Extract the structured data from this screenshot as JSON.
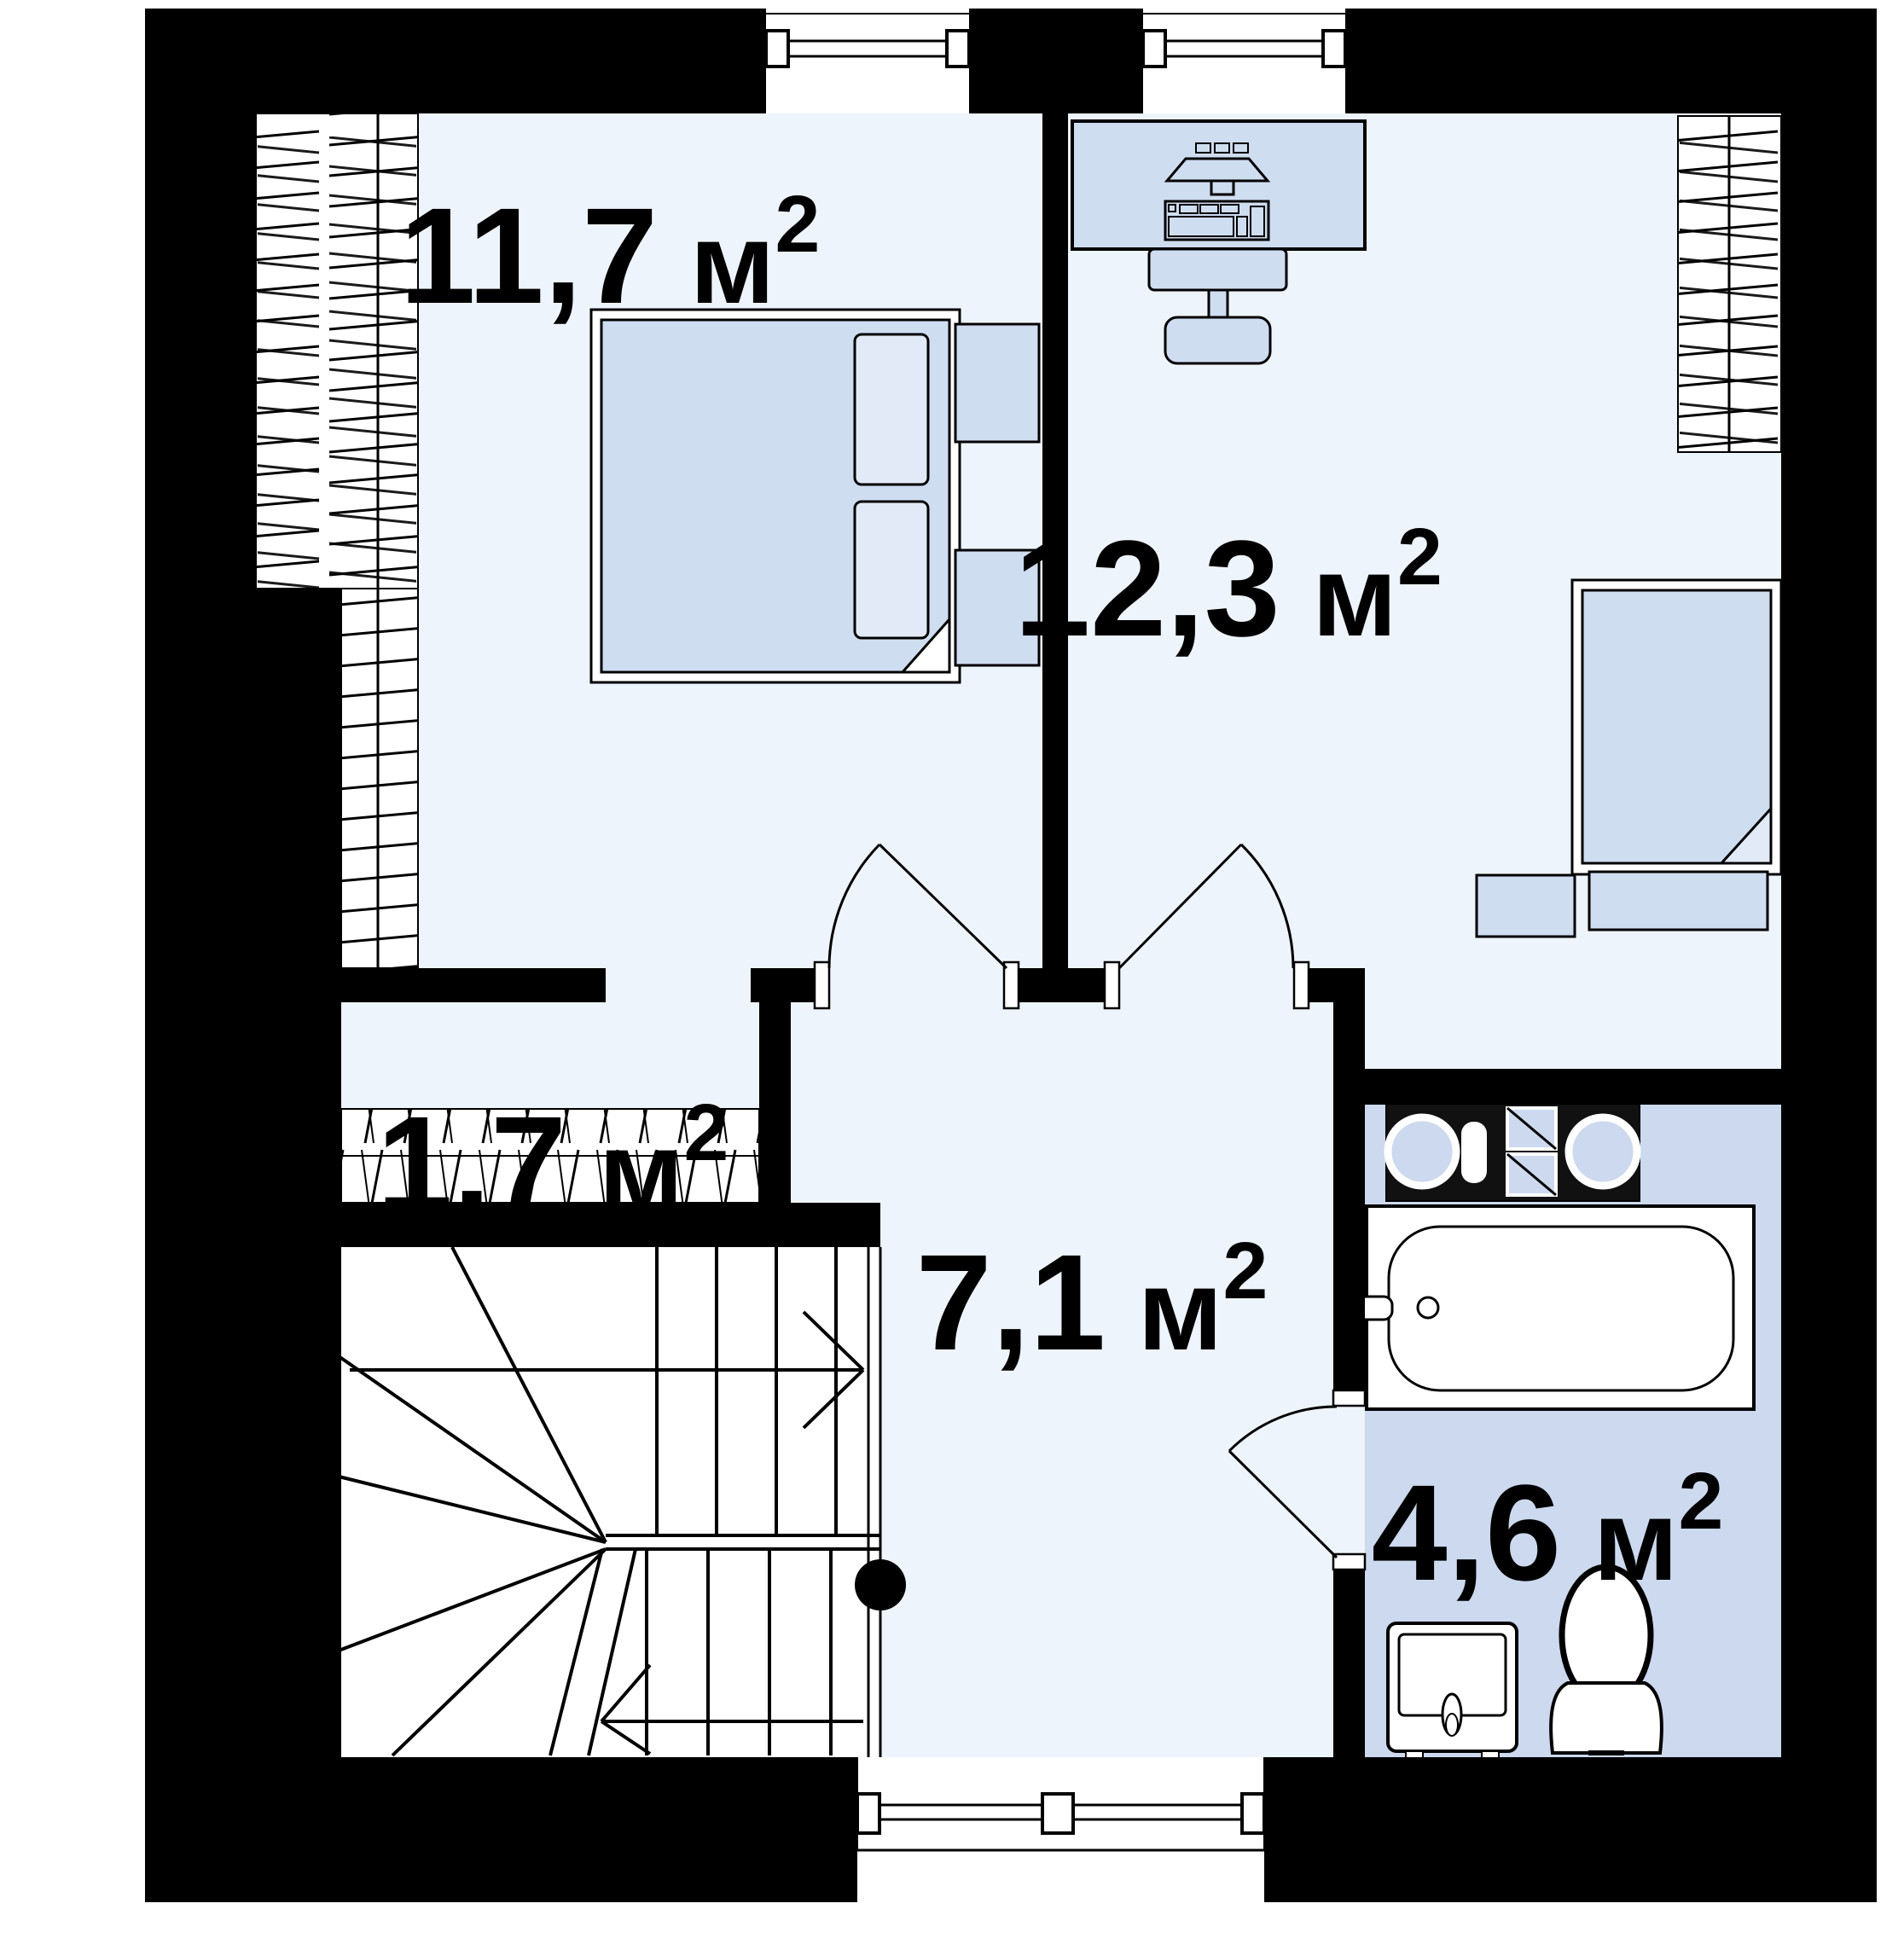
{
  "plan": {
    "type": "floor-plan",
    "unit": "м",
    "superscript": "2",
    "rooms": [
      {
        "id": "bedroom-1",
        "area": "11,7",
        "unit": " м",
        "sup": "2"
      },
      {
        "id": "bedroom-2",
        "area": "12,3",
        "unit": " м",
        "sup": "2"
      },
      {
        "id": "closet",
        "area": "1,7",
        "unit": " м",
        "sup": "2"
      },
      {
        "id": "hall",
        "area": "7,1",
        "unit": " м",
        "sup": "2"
      },
      {
        "id": "bathroom",
        "area": "4,6",
        "unit": " м",
        "sup": "2"
      }
    ],
    "fixtures": [
      "double-bed-icon",
      "single-bed-icon",
      "nightstand-icon",
      "desk-with-computer-icon",
      "office-chair-icon",
      "wardrobe-rail-icon",
      "closet-shelf-icon",
      "winder-staircase-icon",
      "stair-direction-arrow-icon",
      "bathtub-icon",
      "washer-dryer-icon",
      "sink-icon",
      "toilet-icon",
      "window-icon",
      "door-swing-icon"
    ],
    "colors": {
      "wall": "#000000",
      "room_floor": "#eef4fb",
      "bathroom_floor": "#ccd9ee",
      "furniture": "#cfddf1",
      "furniture_light": "#e2eaf7",
      "line": "#000000",
      "background": "#ffffff"
    }
  }
}
